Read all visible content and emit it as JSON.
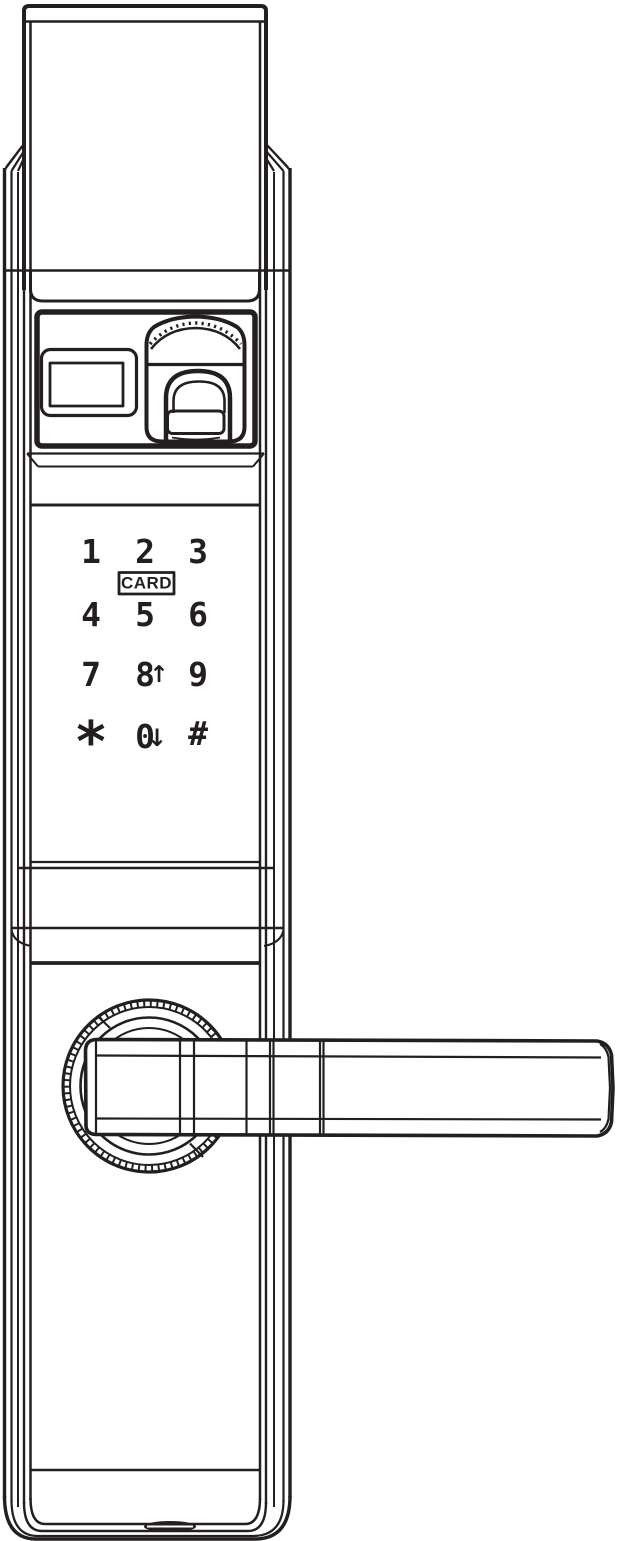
{
  "colors": {
    "line": "#231f20",
    "background": "#ffffff"
  },
  "keypad": {
    "keys": [
      "1",
      "2",
      "3",
      "4",
      "5",
      "6",
      "7",
      "8",
      "9",
      "*",
      "0",
      "#"
    ],
    "card_label": "CARD",
    "up_arrow": "↑",
    "down_arrow": "↓"
  },
  "icons": {
    "fingerprint_reader": "fingerprint-scanner-with-slide-cover",
    "display_window": "status-display-window",
    "card_badge": "card-reader-label",
    "handle": "door-lever-handle",
    "rosette": "knurled-handle-rosette",
    "keyway": "bottom-key-slot"
  }
}
